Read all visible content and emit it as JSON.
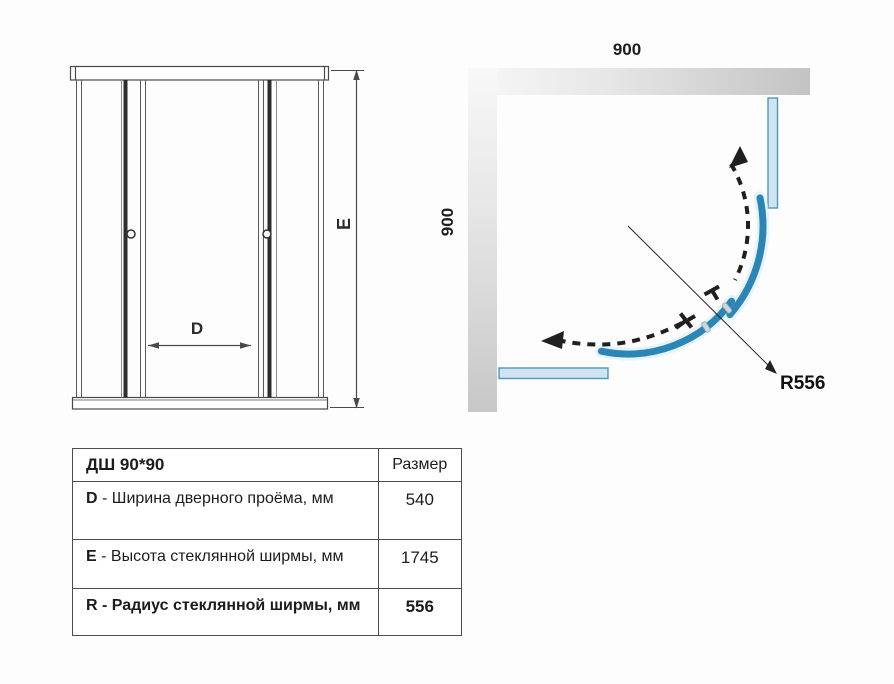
{
  "front_view": {
    "door_width_label": "D",
    "height_label": "E"
  },
  "top_view": {
    "top_dimension": "900",
    "side_dimension": "900",
    "radius_dimension": "R556"
  },
  "spec_table": {
    "header": {
      "model": "ДШ 90*90",
      "size_column": "Размер"
    },
    "rows": [
      {
        "key": "D",
        "description": " - Ширина дверного проёма, мм",
        "value": "540"
      },
      {
        "key": "E",
        "description": " - Высота стеклянной ширмы, мм",
        "value": "1745"
      },
      {
        "key": "R",
        "description": " - Радиус стеклянной ширмы, мм",
        "value": "556"
      }
    ]
  },
  "colors": {
    "door_arc_blue": "#2b86b5",
    "glass_fill": "#cfe4f0",
    "glass_border": "#4e97ba",
    "wall_gray": "#c7c7c7",
    "line_color": "#4a4a4a"
  }
}
